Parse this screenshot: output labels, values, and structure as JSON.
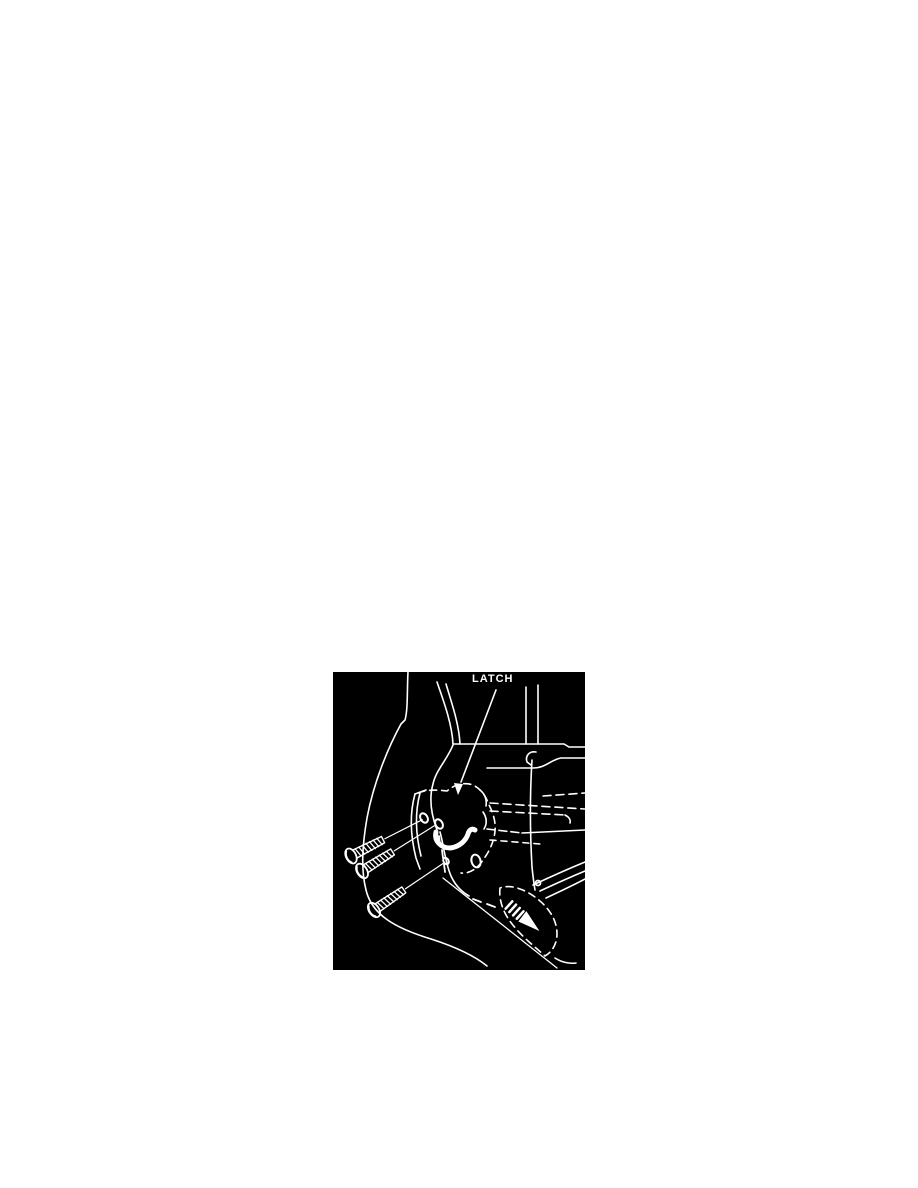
{
  "page": {
    "background_color": "#ffffff"
  },
  "figure": {
    "label": "LATCH",
    "background_color": "#000000",
    "line_color": "#ffffff",
    "subject": "door-latch-assembly-with-three-screws"
  }
}
